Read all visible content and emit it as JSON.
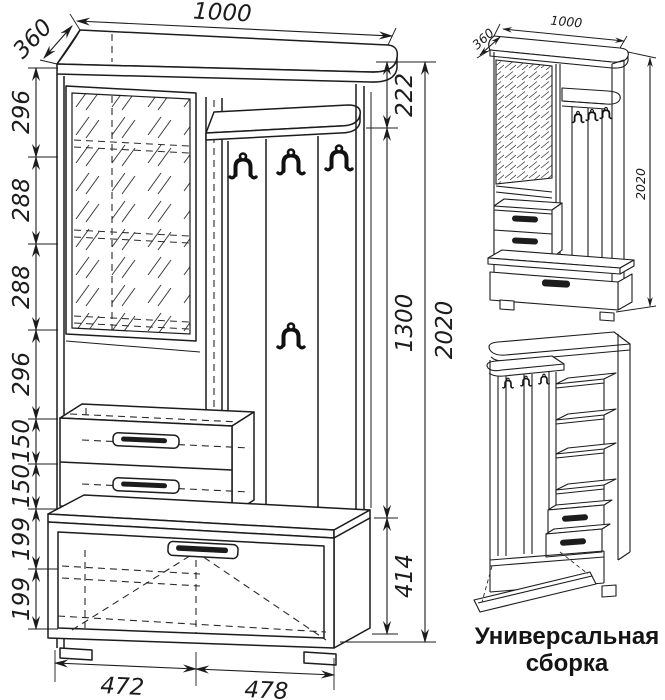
{
  "page": {
    "background": "#ffffff",
    "line_color": "#1c1c1c"
  },
  "main_view": {
    "dim_top_width": "1000",
    "dim_top_depth": "360",
    "left_heights": [
      "296",
      "288",
      "288",
      "296",
      "150",
      "150",
      "199",
      "199"
    ],
    "right_heights": {
      "top": "222",
      "middle": "1300",
      "bottom": "414",
      "overall": "2020"
    },
    "bottom_widths": {
      "left": "472",
      "right": "478"
    }
  },
  "assembly_view": {
    "dim_depth": "360",
    "dim_width": "1000",
    "dim_height": "2020"
  },
  "caption": {
    "line1": "Универсальная",
    "line2": "сборка"
  }
}
